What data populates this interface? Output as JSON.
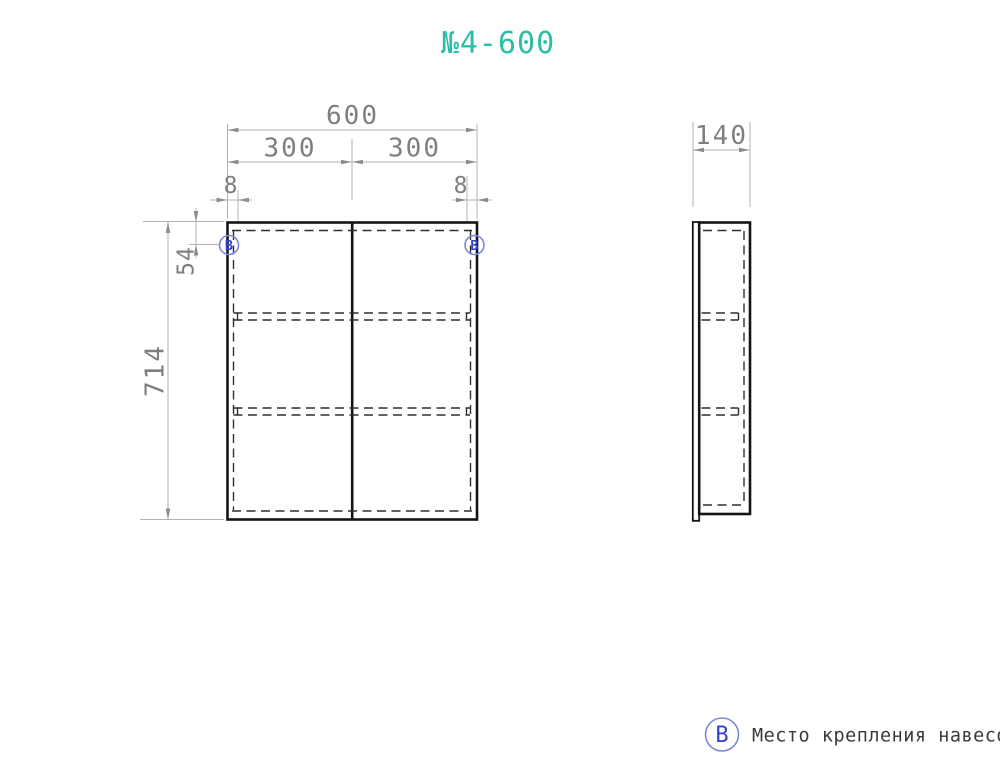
{
  "title": "№4-600",
  "colors": {
    "title": "#2CBFA6",
    "dim_text": "#7f7f7f",
    "dim_line": "#b3b3b3",
    "arrow": "#8c8c8c",
    "outline": "#141414",
    "hidden": "#2f2f2f",
    "marker_ring": "#7c86db",
    "marker_letter": "#3243cd",
    "legend_text": "#3a3a3a"
  },
  "front_view": {
    "dim_total_width": "600",
    "dim_left_door": "300",
    "dim_right_door": "300",
    "dim_offset_left": "8",
    "dim_offset_right": "8",
    "dim_height": "714",
    "dim_hinge_top": "54",
    "marker_left": "B",
    "marker_right": "B"
  },
  "side_view": {
    "dim_depth": "140"
  },
  "legend": {
    "marker": "B",
    "label": "Место крепления навесов"
  }
}
